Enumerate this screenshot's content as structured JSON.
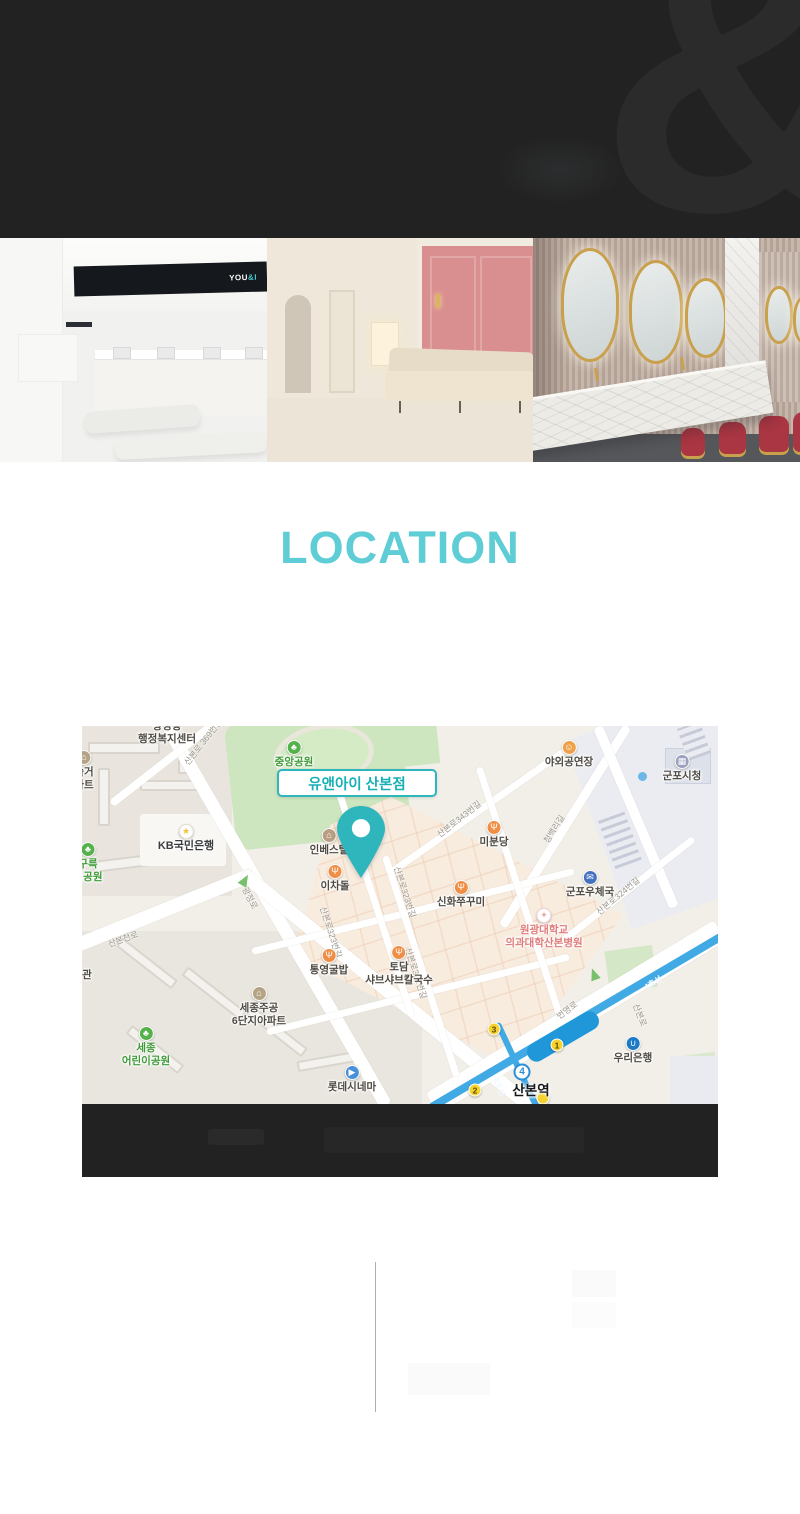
{
  "header": {
    "watermark": "&",
    "bg": "#222222",
    "watermark_color": "#2b2b2b"
  },
  "gallery": {
    "logo": {
      "white": "YOU",
      "teal": "&I"
    },
    "photos": [
      "reception-interior",
      "lounge-hallway-interior",
      "powder-room-interior"
    ]
  },
  "location_section": {
    "title": "LOCATION",
    "title_color": "#5ecdd5"
  },
  "map": {
    "marker": {
      "label_brand": "유앤아이",
      "label_branch": "산본점",
      "pin_color": "#2fb5bc"
    },
    "station": {
      "name": "산본역",
      "badge": "4"
    },
    "exits": [
      {
        "n": "3",
        "x": 412,
        "y": 303
      },
      {
        "n": "1",
        "x": 475,
        "y": 319
      },
      {
        "n": "2",
        "x": 393,
        "y": 364
      },
      {
        "n": "",
        "x": 461,
        "y": 372
      }
    ],
    "labels": [
      {
        "kind": "area",
        "lines": [
          "광정동",
          "행정복지센터"
        ],
        "x": 85,
        "y": -6
      },
      {
        "kind": "poi",
        "icon": "park",
        "lines": [
          "중앙공원"
        ],
        "x": 212,
        "y": 14,
        "tone": "park"
      },
      {
        "kind": "poi",
        "icon": "apt",
        "lines": [
          "솔거",
          "파트"
        ],
        "x": 2,
        "y": 24
      },
      {
        "kind": "poi",
        "icon": "smiley",
        "lines": [
          "야외공연장"
        ],
        "x": 487,
        "y": 14
      },
      {
        "kind": "poi",
        "icon": "civic",
        "lines": [
          "군포시청"
        ],
        "x": 600,
        "y": 28
      },
      {
        "kind": "poi",
        "icon": "bank_kb",
        "lines": [
          "KB국민은행"
        ],
        "x": 104,
        "y": 98,
        "tone": "bold"
      },
      {
        "kind": "poi",
        "icon": "lodging",
        "lines": [
          "인베스텔"
        ],
        "x": 247,
        "y": 102
      },
      {
        "kind": "poi",
        "icon": "restaurant",
        "lines": [
          "미분당"
        ],
        "x": 412,
        "y": 94
      },
      {
        "kind": "poi",
        "icon": "park",
        "lines": [
          "구륵",
          "이공원"
        ],
        "x": 6,
        "y": 116,
        "tone": "park"
      },
      {
        "kind": "poi",
        "icon": "restaurant",
        "lines": [
          "이차돌"
        ],
        "x": 253,
        "y": 138
      },
      {
        "kind": "poi",
        "icon": "restaurant",
        "lines": [
          "신화쭈꾸미"
        ],
        "x": 379,
        "y": 154
      },
      {
        "kind": "poi",
        "icon": "post",
        "lines": [
          "군포우체국"
        ],
        "x": 508,
        "y": 144
      },
      {
        "kind": "poi",
        "icon": "hospital",
        "lines": [
          "원광대학교",
          "의과대학산본병원"
        ],
        "x": 462,
        "y": 182,
        "tone": "hospital"
      },
      {
        "kind": "poi",
        "icon": "restaurant",
        "lines": [
          "통영굴밥"
        ],
        "x": 247,
        "y": 222
      },
      {
        "kind": "poi",
        "icon": "restaurant",
        "lines": [
          "토담",
          "샤브샤브칼국수"
        ],
        "x": 317,
        "y": 219
      },
      {
        "kind": "poi",
        "icon": "apt",
        "lines": [
          "세종주공",
          "6단지아파트"
        ],
        "x": 177,
        "y": 260
      },
      {
        "kind": "poi",
        "icon": "park",
        "lines": [
          "세종",
          "어린이공원"
        ],
        "x": 64,
        "y": 300,
        "tone": "park"
      },
      {
        "kind": "poi",
        "icon": "cinema",
        "lines": [
          "롯데시네마"
        ],
        "x": 270,
        "y": 339
      },
      {
        "kind": "poi",
        "icon": "woori",
        "lines": [
          "우리은행"
        ],
        "x": 551,
        "y": 310
      },
      {
        "kind": "area",
        "lines": [
          "관"
        ],
        "x": 5,
        "y": 243
      },
      {
        "kind": "road",
        "text": "산본로 369번길",
        "x": 121,
        "y": 16,
        "rot": -52
      },
      {
        "kind": "road",
        "text": "산본로343번길",
        "x": 377,
        "y": 93,
        "rot": -38
      },
      {
        "kind": "road",
        "text": "청백리길",
        "x": 472,
        "y": 103,
        "rot": -58
      },
      {
        "kind": "road",
        "text": "산본로324번길",
        "x": 536,
        "y": 170,
        "rot": -40
      },
      {
        "kind": "road",
        "text": "산본로323번길",
        "x": 323,
        "y": 166,
        "rot": 72
      },
      {
        "kind": "road",
        "text": "산본로323번길",
        "x": 249,
        "y": 206,
        "rot": 72
      },
      {
        "kind": "road",
        "text": "산본로322번길",
        "x": 334,
        "y": 247,
        "rot": 72
      },
      {
        "kind": "road",
        "text": "광정로",
        "x": 168,
        "y": 172,
        "rot": 62
      },
      {
        "kind": "road",
        "text": "산본천로",
        "x": 41,
        "y": 213,
        "rot": -20
      },
      {
        "kind": "road",
        "text": "번영로",
        "x": 485,
        "y": 284,
        "rot": -36
      },
      {
        "kind": "road",
        "text": "산본로",
        "x": 558,
        "y": 289,
        "rot": 68
      },
      {
        "kind": "line4",
        "text": "4호선",
        "x": 571,
        "y": 257,
        "rot": -31
      },
      {
        "kind": "line4",
        "text": "4호선",
        "x": 417,
        "y": 361,
        "rot": 66
      }
    ]
  },
  "colors": {
    "accent_teal": "#5ecdd5",
    "marker_teal": "#2fb5bc",
    "subway_line": "#41aae4",
    "exit_yellow": "#f6d22f",
    "map_bg": "#f2efe9",
    "park_green": "#cde6bf",
    "district_peach": "#f8ecdf",
    "dark_bar": "#222222"
  }
}
